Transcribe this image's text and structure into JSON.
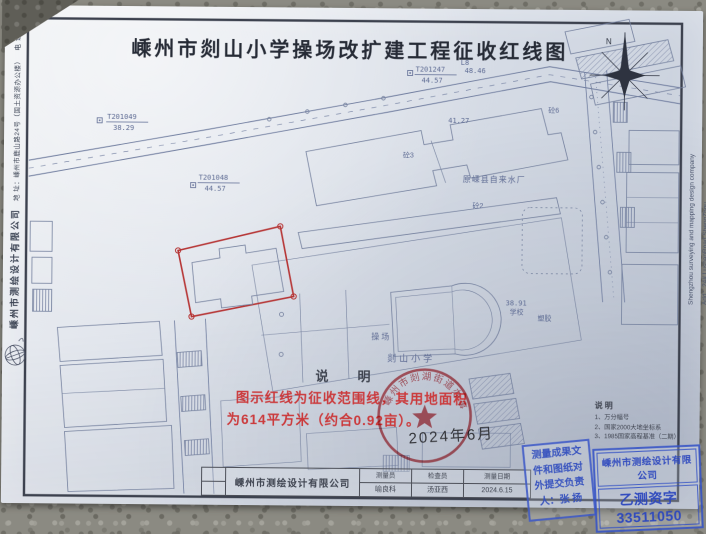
{
  "title": "嵊州市剡山小学操场改扩建工程征收红线图",
  "margins": {
    "left": {
      "company": "嵊州市测绘设计有限公司",
      "address": "地 址：嵊州市鹿山路24号（国土资源办公楼）",
      "contact": "电 话：0575-83106800　E-mail：szchsj@163.com"
    },
    "right": {
      "line1": "Shengzhou surveying and mapping design company",
      "line2": "Add：24# LushanRoad ShengZhou"
    }
  },
  "notes": {
    "heading": "说　明",
    "line1": "图示红线为征收范围线，其用地面积",
    "line2": "为614平方米（约合0.92亩）。",
    "date": "2024年6月"
  },
  "legend": {
    "heading": "说明",
    "items": [
      "1、万分幅号",
      "2、国家2000大地坐标系",
      "3、1985国家高程基准（二期）"
    ]
  },
  "seal": {
    "text": "嵊州市剡湖街道办事处",
    "color": "#c23b45"
  },
  "stamps": {
    "examiner": {
      "lines": [
        "测量成果文",
        "件和图纸对",
        "外提交负责",
        "人：张  扬"
      ]
    },
    "company": {
      "name": "嵊州市测绘设计有限公司",
      "license": "乙测资字33511050"
    }
  },
  "titleblock": {
    "company": "嵊州市测绘设计有限公司",
    "cols": [
      {
        "label": "测量员",
        "value": "喻良科"
      },
      {
        "label": "检查员",
        "value": "汤亚西"
      },
      {
        "label": "测量日期",
        "value": "2024.6.15"
      }
    ]
  },
  "compass": {
    "label": "N"
  },
  "map": {
    "labels": [
      {
        "text": "剡山小学"
      },
      {
        "text": "操场"
      },
      {
        "text": "原嵊县自来水厂"
      },
      {
        "text": "学校"
      },
      {
        "text": "塑胶"
      },
      {
        "text": "砼3"
      },
      {
        "text": "砼2"
      },
      {
        "text": "砼6"
      }
    ],
    "points": [
      {
        "id": "T201049",
        "elev": "38.29"
      },
      {
        "id": "T201048",
        "elev": "44.57"
      },
      {
        "id": "T201247",
        "elev": "44.57"
      }
    ],
    "extra": {
      "l8": "L8",
      "l8_elev": "48.46"
    },
    "elevations": [
      {
        "v": "41.27"
      },
      {
        "v": "38.91"
      }
    ],
    "red_line_color": "#b63535"
  }
}
